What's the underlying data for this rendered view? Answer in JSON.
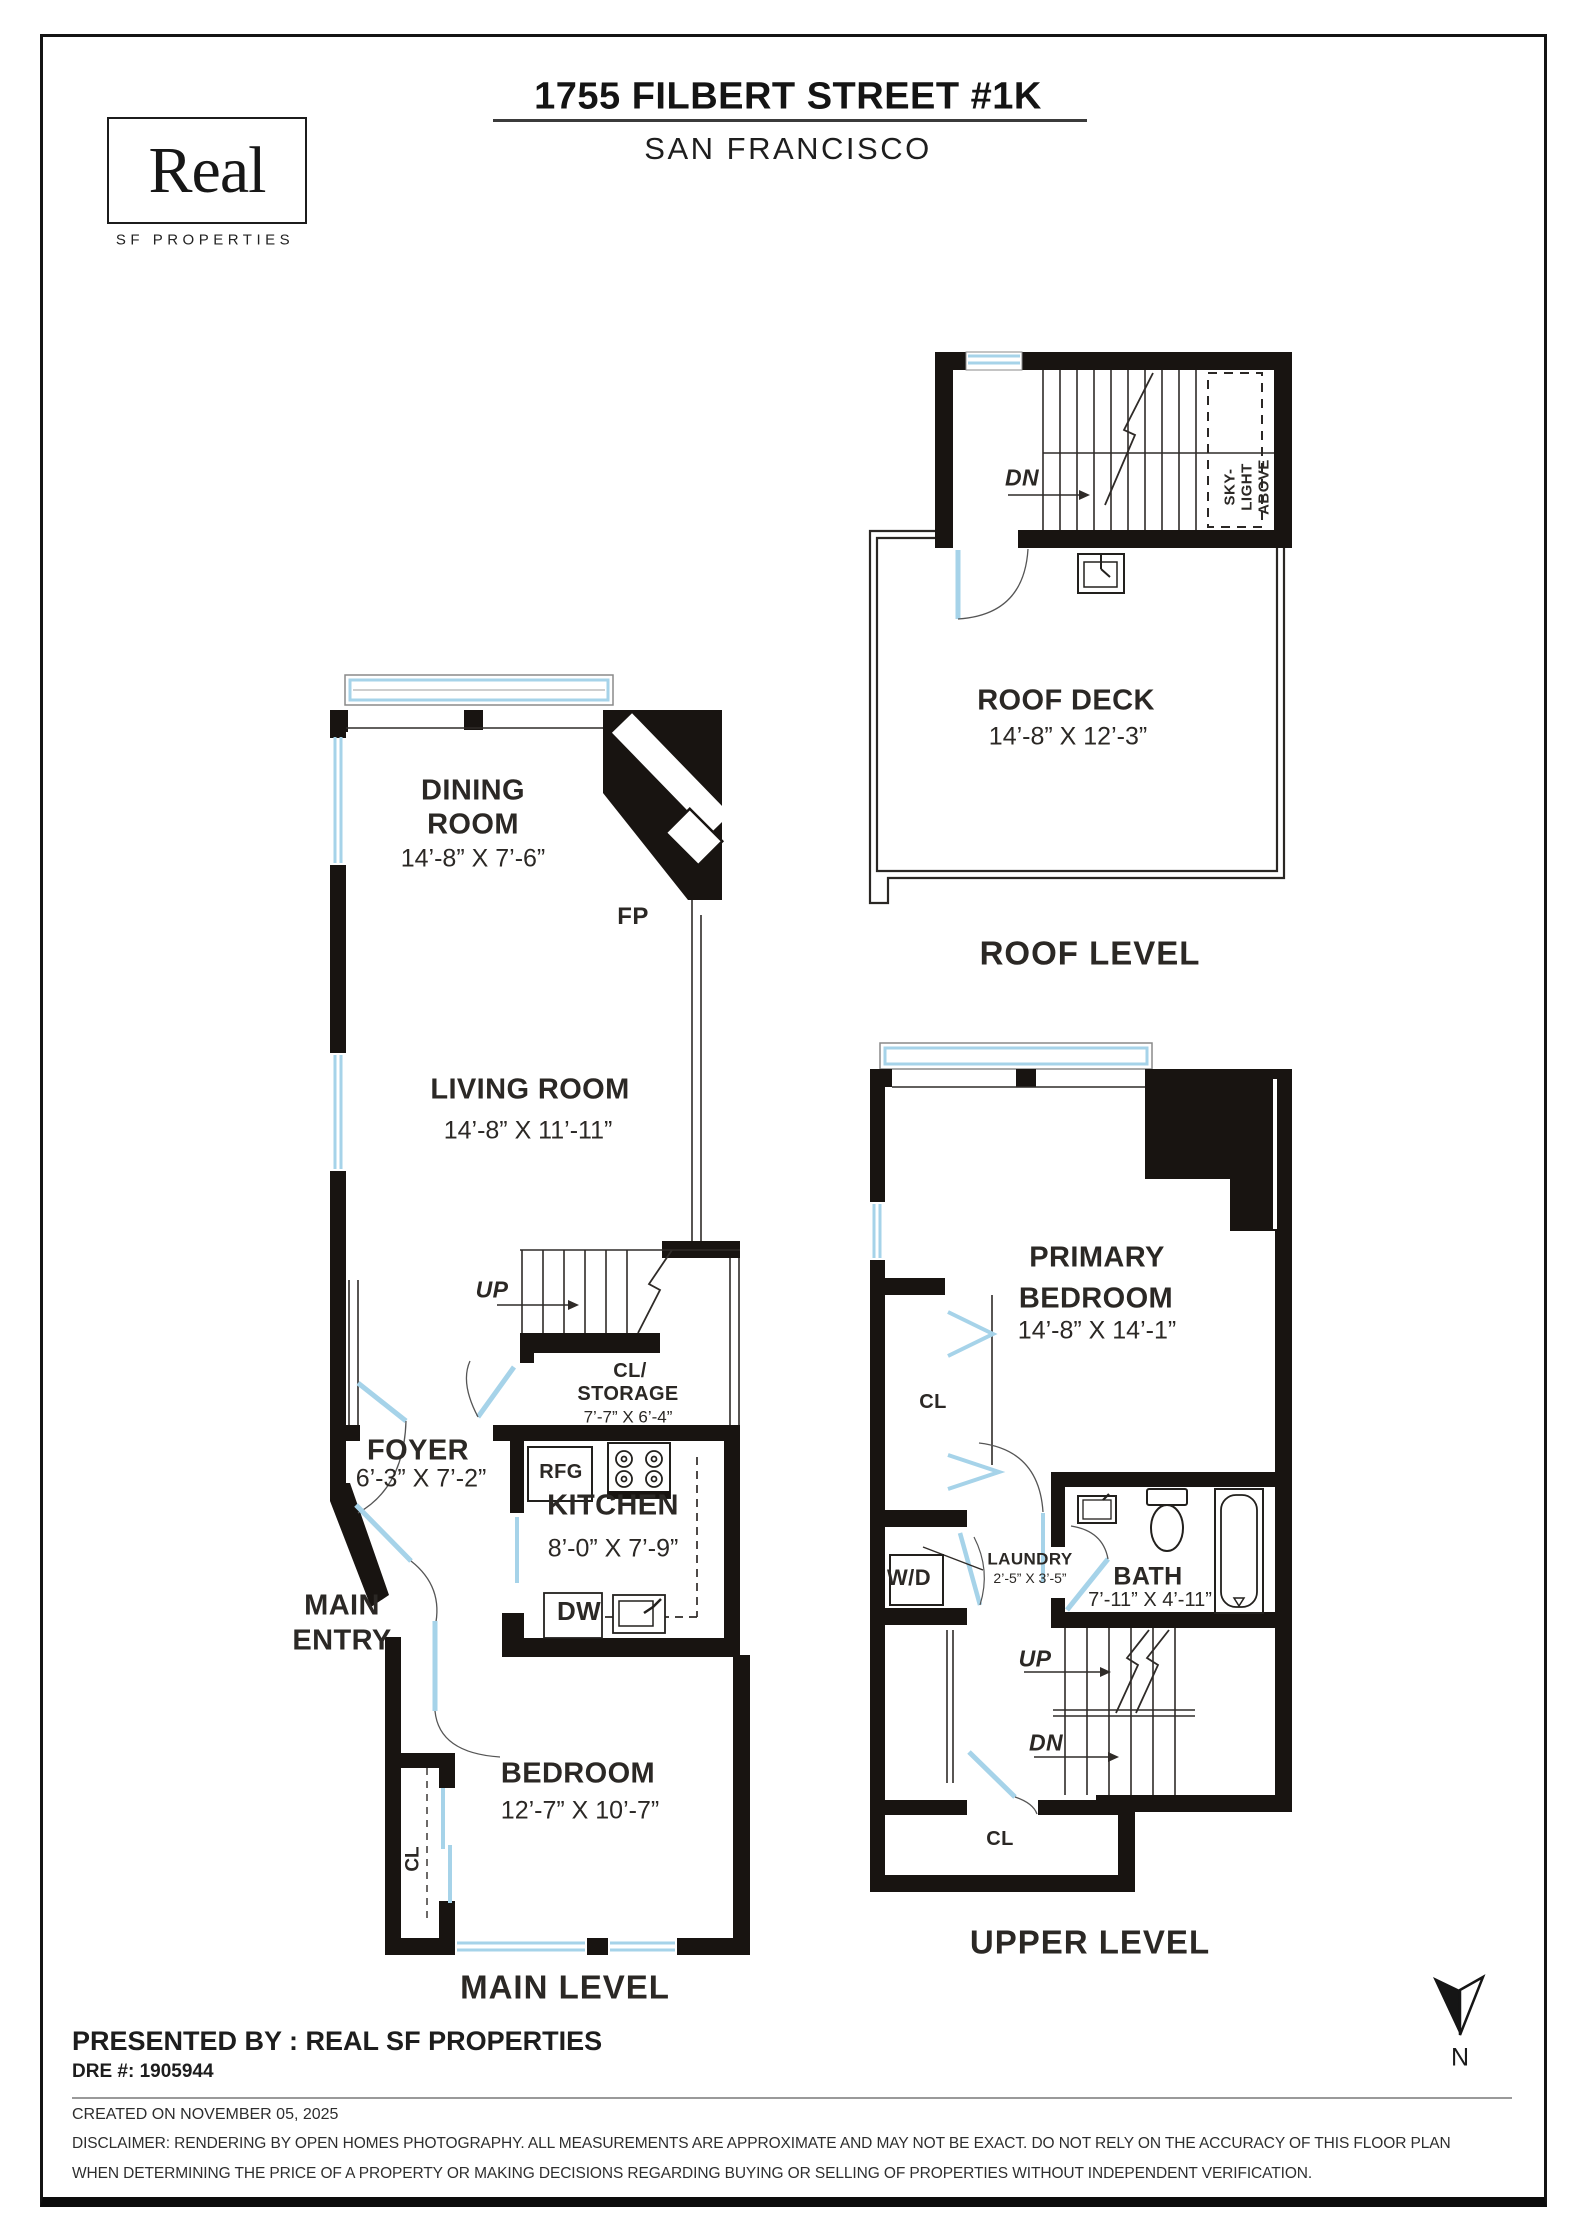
{
  "header": {
    "logo_name": "Real",
    "logo_sub": "SF PROPERTIES",
    "title": "1755 FILBERT STREET #1K",
    "subtitle": "SAN FRANCISCO"
  },
  "roof": {
    "caption": "ROOF LEVEL",
    "dn": "DN",
    "sky1": "SKY-",
    "sky2": "LIGHT",
    "sky3": "ABOVE",
    "deck_name": "ROOF DECK",
    "deck_dims": "14’-8” X 12’-3”"
  },
  "main": {
    "caption": "MAIN LEVEL",
    "dining1": "DINING",
    "dining2": "ROOM",
    "dining_dims": "14’-8” X 7’-6”",
    "fp": "FP",
    "living": "LIVING ROOM",
    "living_dims": "14’-8” X 11’-11”",
    "up": "UP",
    "cl1": "CL/",
    "cl2": "STORAGE",
    "cl_dims": "7’-7” X 6’-4”",
    "foyer": "FOYER",
    "foyer_dims": "6’-3” X 7’-2”",
    "entry1": "MAIN",
    "entry2": "ENTRY",
    "rfg": "RFG",
    "kitchen": "KITCHEN",
    "kitchen_dims": "8’-0” X 7’-9”",
    "dw": "DW",
    "bedroom": "BEDROOM",
    "bedroom_dims": "12’-7” X 10’-7”",
    "cl_closet": "CL"
  },
  "upper": {
    "caption": "UPPER LEVEL",
    "primary1": "PRIMARY",
    "primary2": "BEDROOM",
    "primary_dims": "14’-8” X 14’-1”",
    "cl": "CL",
    "wd": "W/D",
    "laundry": "LAUNDRY",
    "laundry_dims": "2’-5” X 3’-5”",
    "bath": "BATH",
    "bath_dims": "7’-11” X 4’-11”",
    "up": "UP",
    "dn": "DN",
    "cl_bottom": "CL"
  },
  "footer": {
    "presented": "PRESENTED BY : REAL SF PROPERTIES",
    "dre": "DRE #: 1905944",
    "created": "CREATED ON NOVEMBER 05, 2025",
    "disc1": "DISCLAIMER: RENDERING BY OPEN HOMES PHOTOGRAPHY. ALL MEASUREMENTS ARE APPROXIMATE AND MAY NOT BE EXACT. DO NOT RELY ON THE ACCURACY OF THIS FLOOR PLAN",
    "disc2": "WHEN DETERMINING THE PRICE OF A PROPERTY OR MAKING DECISIONS REGARDING BUYING OR SELLING OF PROPERTIES WITHOUT INDEPENDENT VERIFICATION.",
    "north": "N"
  },
  "colors": {
    "wall": "#181411",
    "window_door": "#a6d3e9",
    "text": "#2b2825"
  }
}
